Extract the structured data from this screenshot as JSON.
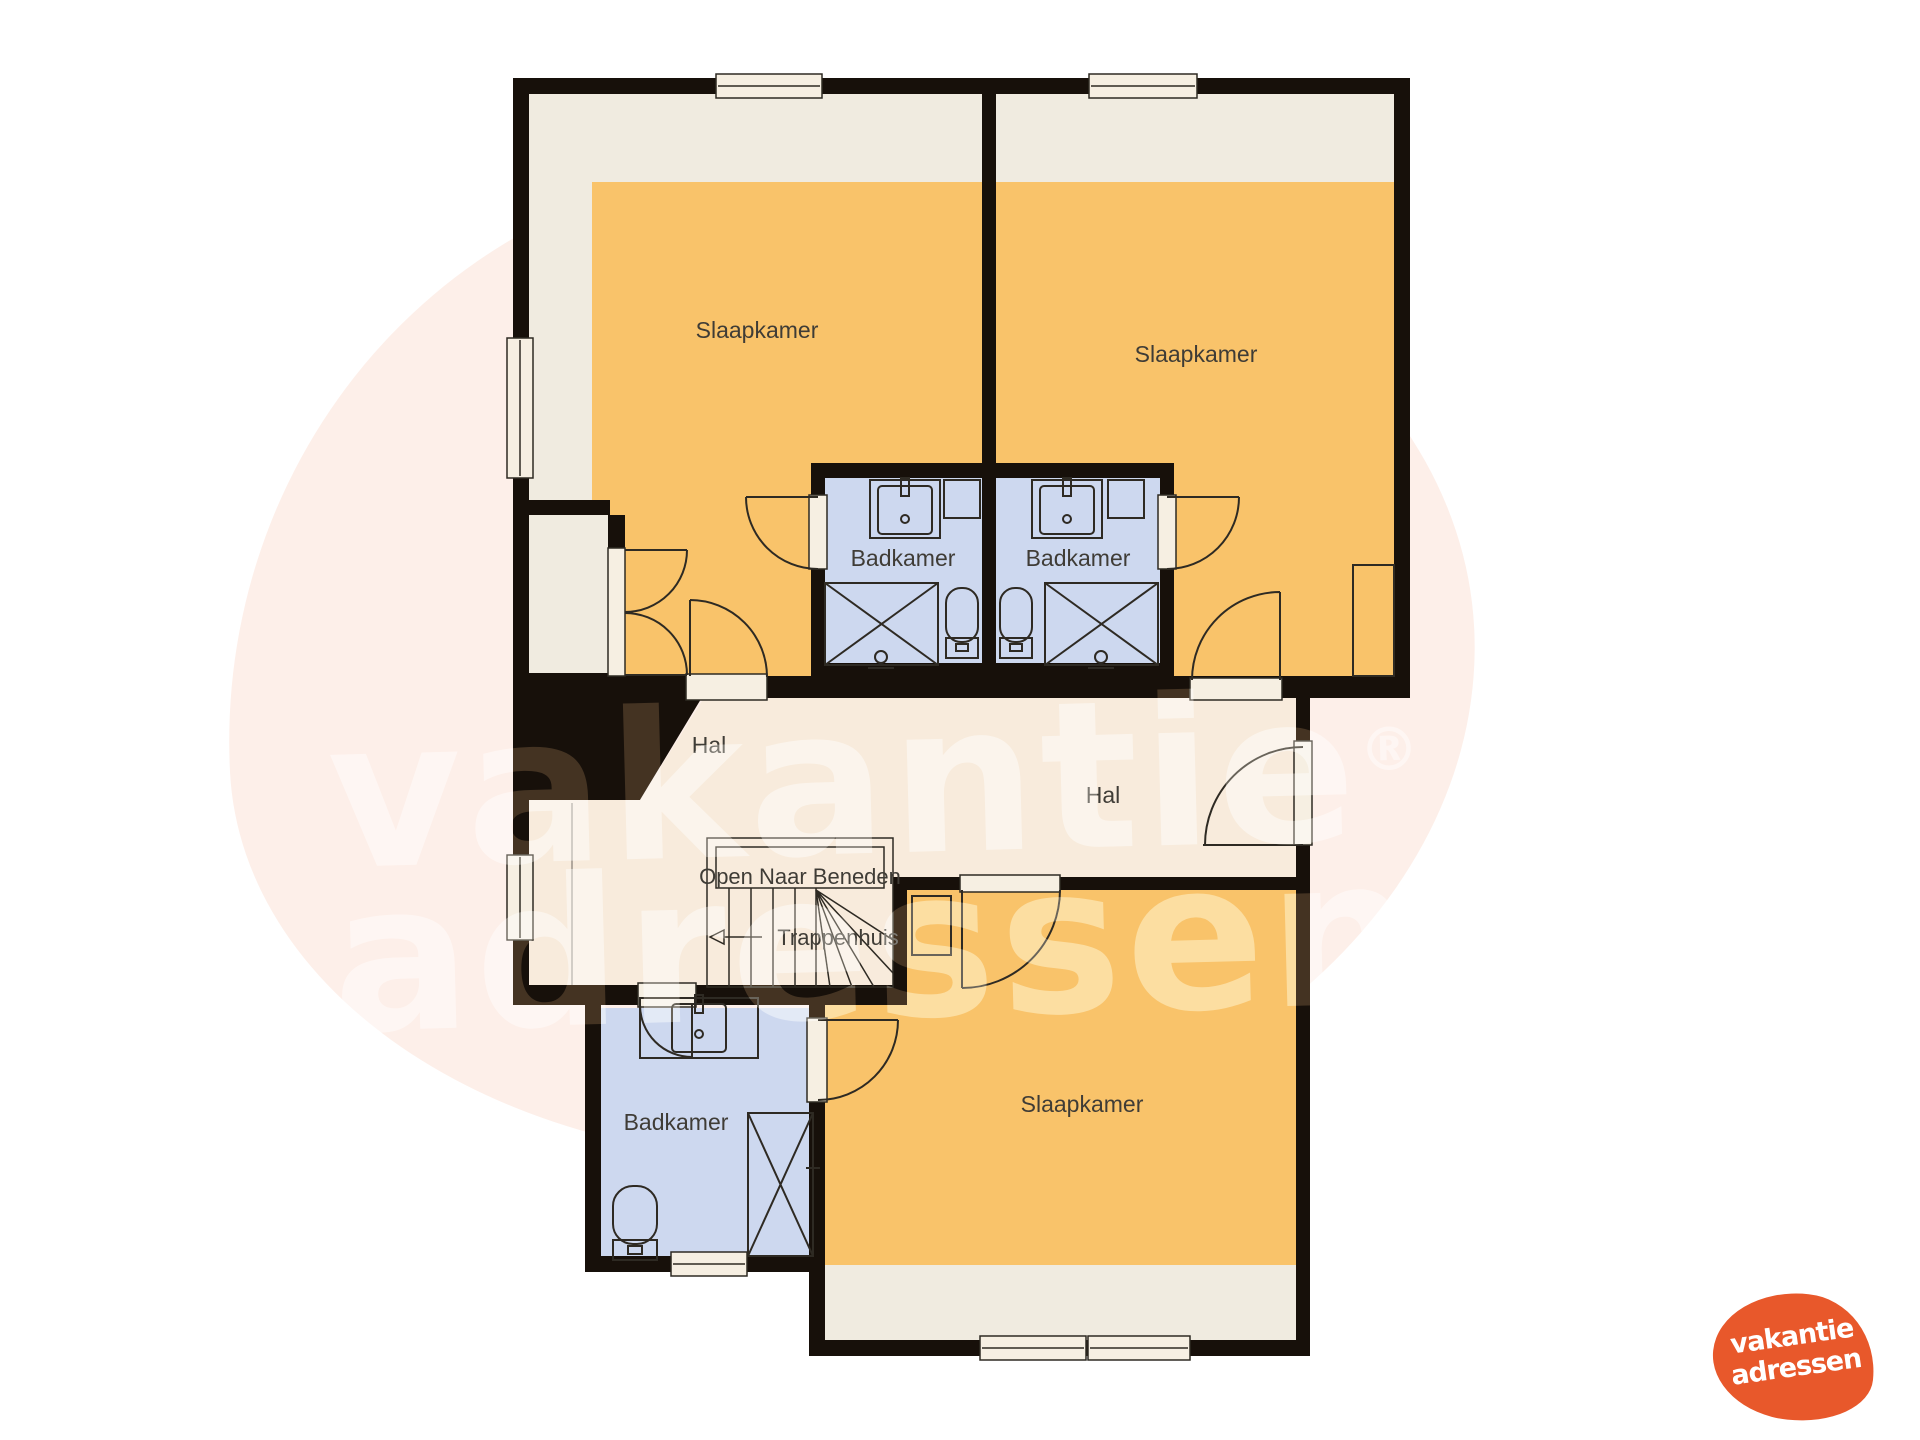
{
  "watermark": {
    "line1": "vakantie",
    "line2": "adressen",
    "registered": "®",
    "color": "#ffffff"
  },
  "logo": {
    "line1": "vakantie",
    "line2": "adressen",
    "blob_color": "#e8582b",
    "text_color": "#ffffff"
  },
  "floorplan": {
    "rooms": {
      "slaapkamer_top_left": "Slaapkamer",
      "slaapkamer_top_right": "Slaapkamer",
      "badkamer_top_left": "Badkamer",
      "badkamer_top_right": "Badkamer",
      "hal_left": "Hal",
      "hal_right": "Hal",
      "open_naar_beneden": "Open Naar Beneden",
      "trappenhuis": "Trappenhuis",
      "badkamer_bottom": "Badkamer",
      "slaapkamer_bottom": "Slaapkamer"
    },
    "colors": {
      "wall": "#17100a",
      "bedroom_floor": "#f0ebe0",
      "bedroom_accent": "#f9c36a",
      "bathroom_floor": "#cdd8ef",
      "hall_floor": "#f8ebdc",
      "frame_fill": "#f6efe2",
      "outline": "#2e2a23",
      "label": "#3f3c36",
      "background_blob": "#fdefe9"
    }
  }
}
